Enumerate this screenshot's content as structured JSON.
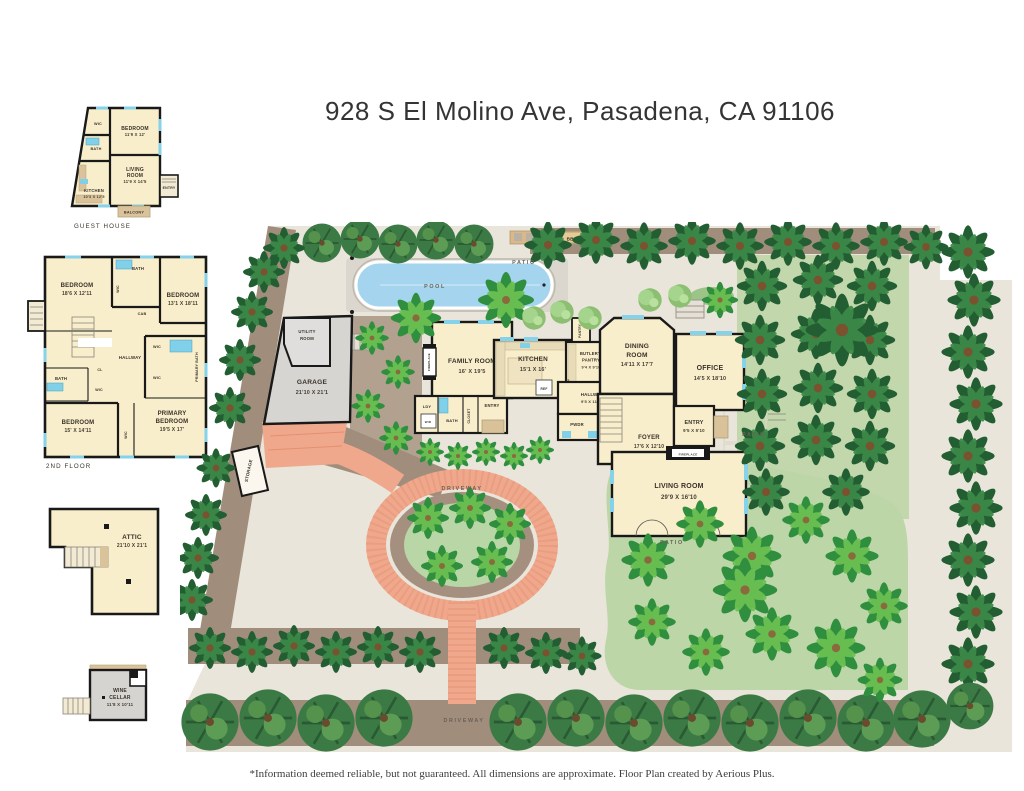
{
  "title": "928 S El Molino Ave, Pasadena, CA 91106",
  "disclaimer": "*Information deemed reliable, but not guaranteed. All dimensions are approximate. Floor Plan created by Aerious Plus.",
  "guest_house": {
    "caption": "GUEST HOUSE",
    "wic": "WIC",
    "bedroom": "BEDROOM",
    "bedroom_dim": "11'9 X 12'",
    "bath": "BATH",
    "living1": "LIVING",
    "living2": "ROOM",
    "living_dim": "11'9 X 14'5",
    "kitchen": "KITCHEN",
    "kitchen_dim": "10'3 X 12'5",
    "entry": "ENTRY",
    "balcony": "BALCONY"
  },
  "second_floor": {
    "caption": "2ND FLOOR",
    "bedroom1": "BEDROOM",
    "bedroom1_dim": "18'6 X 12'11",
    "bath_top": "BATH",
    "wic_top": "WIC",
    "cab": "CAB",
    "bedroom2": "BEDROOM",
    "bedroom2_dim": "13'1 X 18'11",
    "hallway": "HALLWAY",
    "wic_mid": "WIC",
    "primary_bath": "PRIMARY BATH",
    "wic_low": "WIC",
    "bath_left": "BATH",
    "cl": "CL",
    "wic_left": "WIC",
    "bedroom3": "BEDROOM",
    "bedroom3_dim": "15' X 14'11",
    "wic_bottom": "WIC",
    "primary1": "PRIMARY",
    "primary2": "BEDROOM",
    "primary_dim": "19'5 X 17'"
  },
  "attic": {
    "name": "ATTIC",
    "dim": "21'10 X 21'1"
  },
  "wine_cellar": {
    "line1": "WINE",
    "line2": "CELLAR",
    "dim": "11'8 X 10'11"
  },
  "site": {
    "pool": "POOL",
    "bbq": "BBQ",
    "patio": "PATIO",
    "driveway": "DRIVEWAY",
    "storage": "STORAGE",
    "utility1": "UTILITY",
    "utility2": "ROOM",
    "garage": "GARAGE",
    "garage_dim": "21'10 X 21'1",
    "family": "FAMILY ROOM",
    "family_dim": "16' X 19'5",
    "fireplace": "FIREPLACE",
    "ldy": "LDY",
    "wd": "W/D",
    "bath": "BATH",
    "closet": "CLOSET",
    "entry": "ENTRY",
    "kitchen": "KITCHEN",
    "kitchen_dim": "15'1 X 16'",
    "pantry": "PANTRY",
    "ref": "REF",
    "butlers1": "BUTLER'S",
    "butlers2": "PANTRY",
    "butlers_dim": "9'4 X 9'10",
    "dining1": "DINING",
    "dining2": "ROOM",
    "dining_dim": "14'11 X 17'7",
    "office": "OFFICE",
    "office_dim": "14'5 X 18'10",
    "hallway": "HALLWAY",
    "hallway_dim": "9'5 X 11'10",
    "pwdr": "PWDR",
    "cl": "CL",
    "foyer": "FOYER",
    "foyer_dim": "17'6 X 12'10",
    "entry2": "ENTRY",
    "entry2_dim": "9'5 X 5'10",
    "living": "LIVING ROOM",
    "living_dim": "29'9 X 16'10"
  },
  "colors": {
    "ground": "#eae5da",
    "mulch": "#a18d7c",
    "driveway_brick": "#f0a88c",
    "lawn": "#b8d6a6",
    "pool_water": "#a4d4ee",
    "room_cream": "#f8eecb",
    "garage_gray": "#d7d5d1",
    "wall": "#191919"
  }
}
